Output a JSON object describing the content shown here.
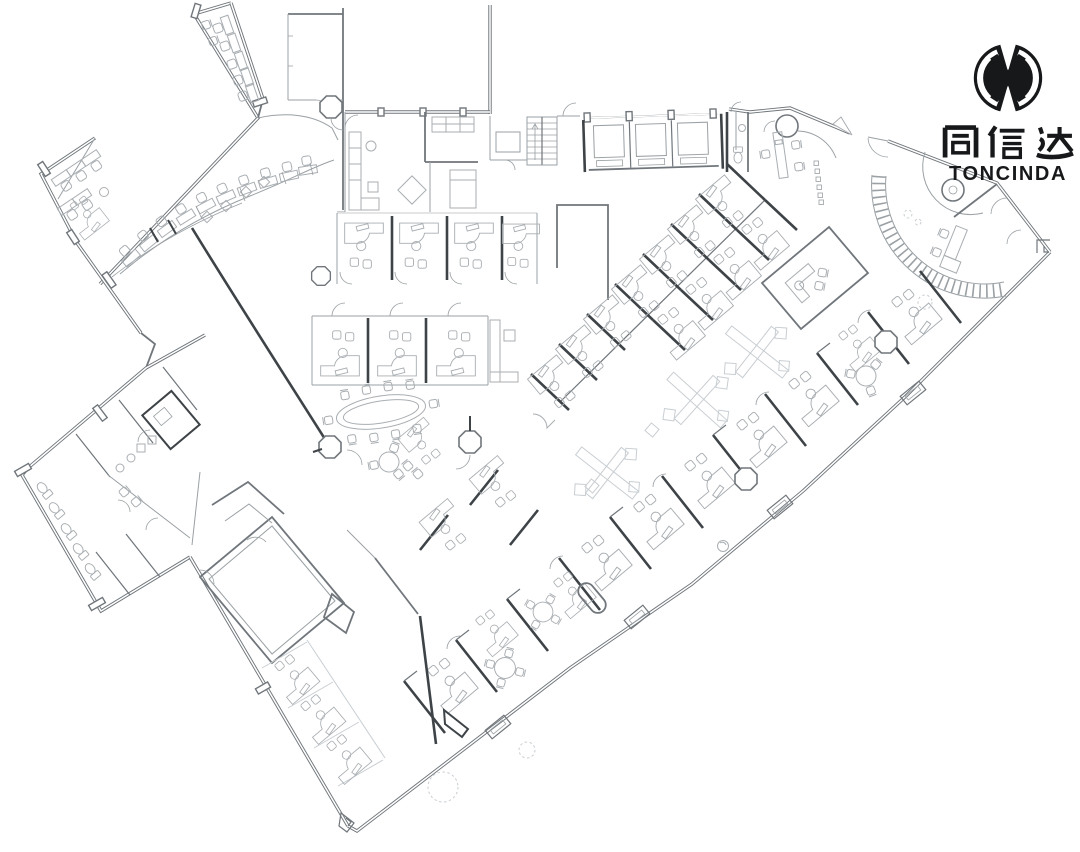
{
  "meta": {
    "artifact": "office-floor-plan-drawing",
    "description": "CAD office floor plan, light gray linework on white"
  },
  "logo": {
    "mark": "toncinda-x-monogram",
    "chinese": "同信达",
    "latin": "TONCINDA",
    "color": "#17181a"
  },
  "palette": {
    "background": "#ffffff",
    "wall_light": "#9aa0a4",
    "wall_medium": "#70767b",
    "partition_dark": "#3e4347",
    "furniture": "#a9aeb2",
    "accent_faint": "#c9ced2",
    "logo": "#17181a"
  },
  "plan": {
    "zones": [
      "top-left-office-wing",
      "left-office-wing",
      "curved-workstation-row",
      "upper-room",
      "lobby-lounge",
      "stairwell",
      "conference-rooms",
      "entrance-vestibule",
      "reception-curve",
      "cubicle-row-upper",
      "cubicle-row-lower",
      "oval-meeting-table",
      "center-cluster",
      "diagonal-office-rows",
      "x-floor-features",
      "manager-office",
      "perimeter-offices",
      "training-room",
      "washroom-wing",
      "corridor-offices"
    ]
  }
}
